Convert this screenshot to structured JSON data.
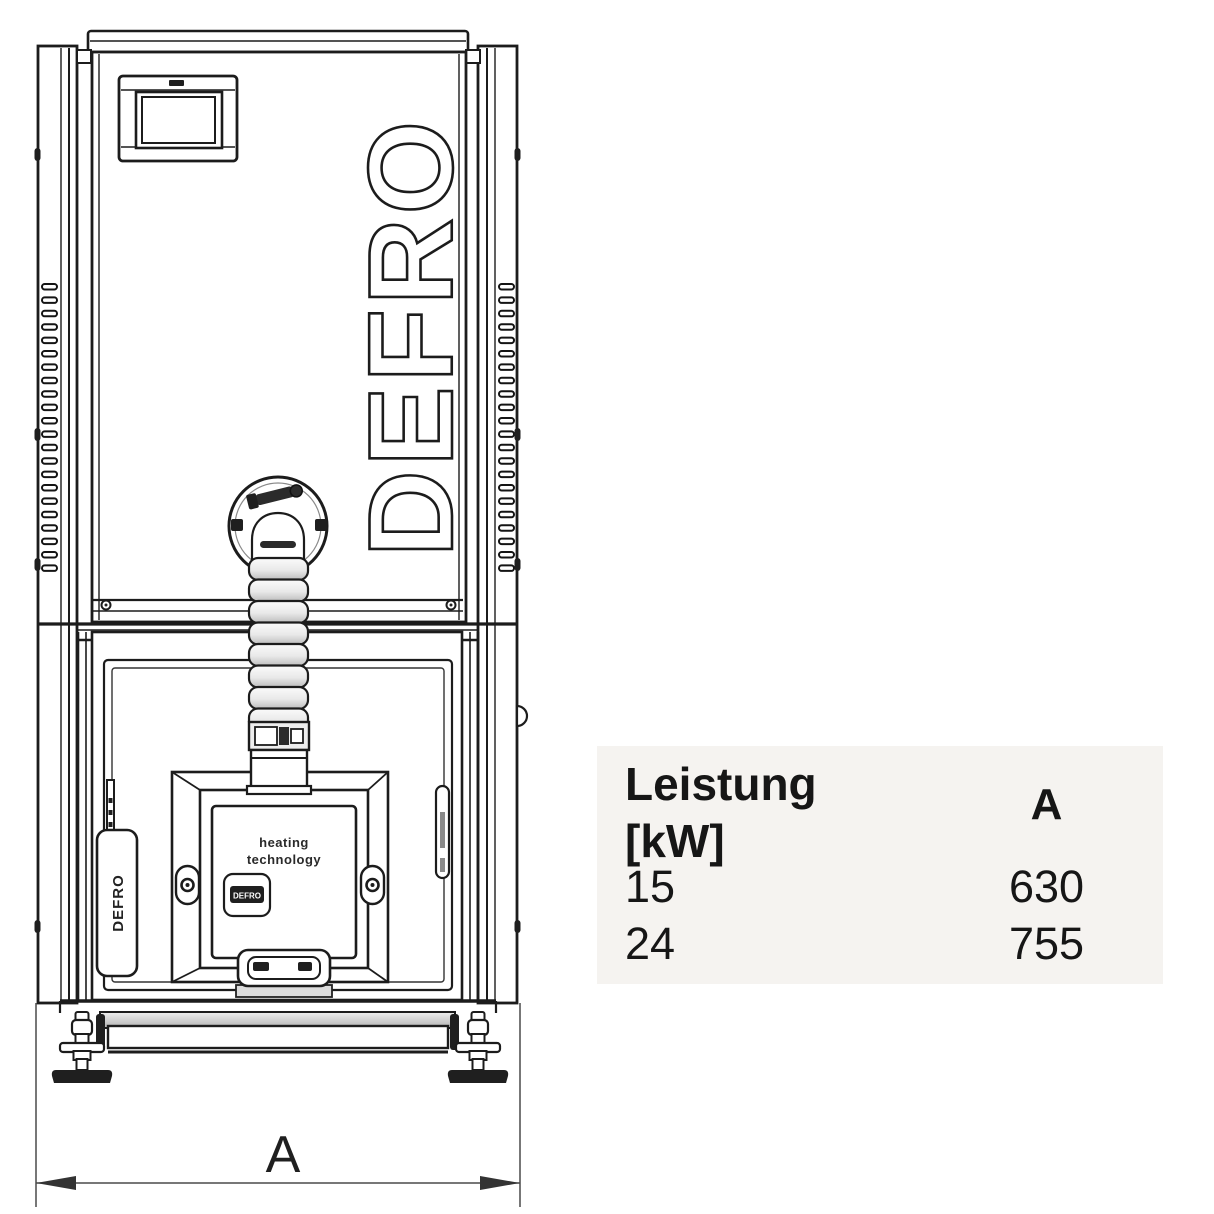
{
  "drawing": {
    "brand": "DEFRO",
    "door_text_line1": "heating",
    "door_text_line2": "technology",
    "badge_text": "DEFRO",
    "thermometer_text": "DEFRO",
    "dimension_label": "A"
  },
  "table": {
    "header": {
      "power_line1": "Leistung",
      "power_line2": "[kW]",
      "dim": "A"
    },
    "rows": [
      {
        "power": "15",
        "dim_a": "630"
      },
      {
        "power": "24",
        "dim_a": "755"
      }
    ],
    "colors": {
      "background": "#f5f3f0",
      "text": "#161616"
    }
  }
}
